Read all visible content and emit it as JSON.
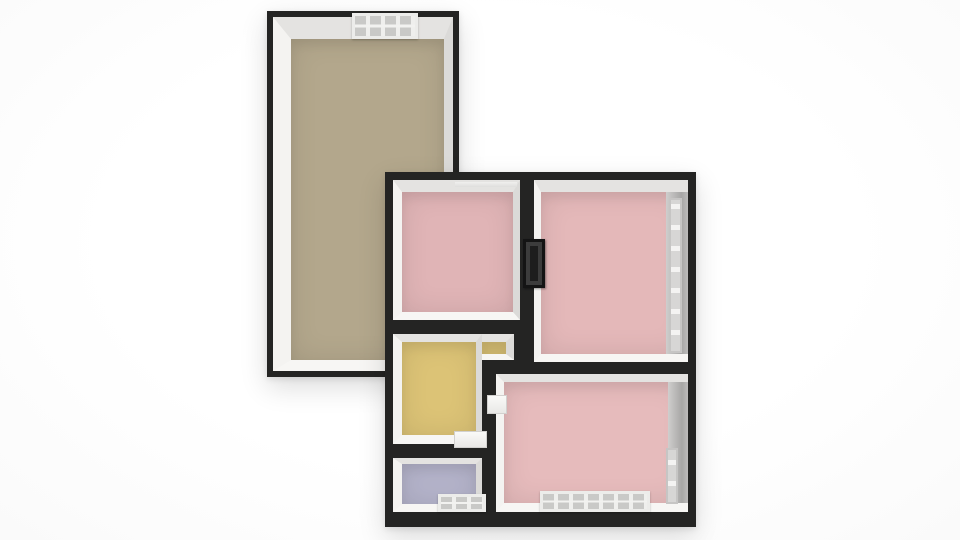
{
  "scene": {
    "description": "3D overhead render of an apartment floor plan on a white background",
    "background": "#ffffff"
  },
  "palette": {
    "wall_black": "#242423",
    "wall_white": "#f2f1ef",
    "wall_gray_inner": "#a7a6a5",
    "window_frame": "#ececea",
    "window_pane": "#c9c9c7"
  },
  "floorplan": {
    "wings": [
      {
        "name": "garage-wing-walls",
        "x": 267,
        "y": 11,
        "w": 192,
        "h": 366,
        "color": "#242423",
        "layer": 1
      },
      {
        "name": "main-wing-walls",
        "x": 385,
        "y": 172,
        "w": 311,
        "h": 355,
        "color": "#242423",
        "layer": 3
      }
    ],
    "rooms": [
      {
        "name": "room-large-tan",
        "x": 273,
        "y": 17,
        "w": 180,
        "h": 354,
        "floor": "#b3a78c",
        "bevel": {
          "t": 22,
          "r": 9,
          "b": 11,
          "l": 18
        },
        "layer": 2
      },
      {
        "name": "room-pink-top-left",
        "x": 393,
        "y": 180,
        "w": 127,
        "h": 140,
        "floor": "#e0b4b6",
        "bevel": {
          "t": 12,
          "r": 7,
          "b": 8,
          "l": 9
        },
        "layer": 4
      },
      {
        "name": "room-pink-top-right",
        "x": 534,
        "y": 180,
        "w": 154,
        "h": 182,
        "floor": "#e4b8b9",
        "bevel": {
          "t": 12,
          "r": 0,
          "b": 8,
          "l": 7
        },
        "right_band": 22,
        "layer": 4
      },
      {
        "name": "room-yellow",
        "x": 393,
        "y": 334,
        "w": 89,
        "h": 110,
        "floor": "#dcc376",
        "bevel": {
          "t": 8,
          "r": 6,
          "b": 9,
          "l": 9
        },
        "layer": 4
      },
      {
        "name": "room-yellow-extension",
        "x": 482,
        "y": 334,
        "w": 32,
        "h": 26,
        "floor": "#dcc376",
        "bevel": {
          "t": 8,
          "r": 8,
          "b": 6,
          "l": 0
        },
        "layer": 4
      },
      {
        "name": "room-lavender",
        "x": 393,
        "y": 458,
        "w": 89,
        "h": 54,
        "floor": "#b5b4cb",
        "bevel": {
          "t": 6,
          "r": 6,
          "b": 8,
          "l": 9
        },
        "layer": 4
      },
      {
        "name": "room-pink-bottom",
        "x": 496,
        "y": 374,
        "w": 192,
        "h": 138,
        "floor": "#e6bbbc",
        "bevel": {
          "t": 8,
          "r": 0,
          "b": 9,
          "l": 8
        },
        "right_band": 20,
        "layer": 4
      }
    ],
    "features": [
      {
        "name": "skylight-window-top-wall",
        "type": "window-h",
        "x": 352,
        "y": 13,
        "w": 66,
        "h": 26,
        "layer": 5
      },
      {
        "name": "window-lintel-pink-top-left",
        "type": "sill",
        "x": 455,
        "y": 182,
        "w": 62,
        "h": 5,
        "layer": 5
      },
      {
        "name": "door-dark-panel-between-pinks",
        "type": "dark-panel",
        "x": 523,
        "y": 239,
        "w": 22,
        "h": 49,
        "layer": 5
      },
      {
        "name": "window-tall-right-wall",
        "type": "window-v",
        "x": 669,
        "y": 198,
        "w": 13,
        "h": 155,
        "layer": 5
      },
      {
        "name": "door-threshold-yellow-room",
        "type": "threshold",
        "x": 454,
        "y": 431,
        "w": 33,
        "h": 17,
        "layer": 5
      },
      {
        "name": "door-opening-bottom-pink-left",
        "type": "threshold",
        "x": 487,
        "y": 395,
        "w": 20,
        "h": 19,
        "layer": 5
      },
      {
        "name": "window-lavender-bottom-wall",
        "type": "window-h",
        "x": 438,
        "y": 494,
        "w": 48,
        "h": 18,
        "layer": 5
      },
      {
        "name": "window-vent-bottom-pink-floor",
        "type": "window-h",
        "x": 540,
        "y": 491,
        "w": 110,
        "h": 21,
        "layer": 5
      },
      {
        "name": "window-small-right-wall-bottom",
        "type": "window-v",
        "x": 666,
        "y": 448,
        "w": 12,
        "h": 56,
        "layer": 5
      }
    ]
  }
}
